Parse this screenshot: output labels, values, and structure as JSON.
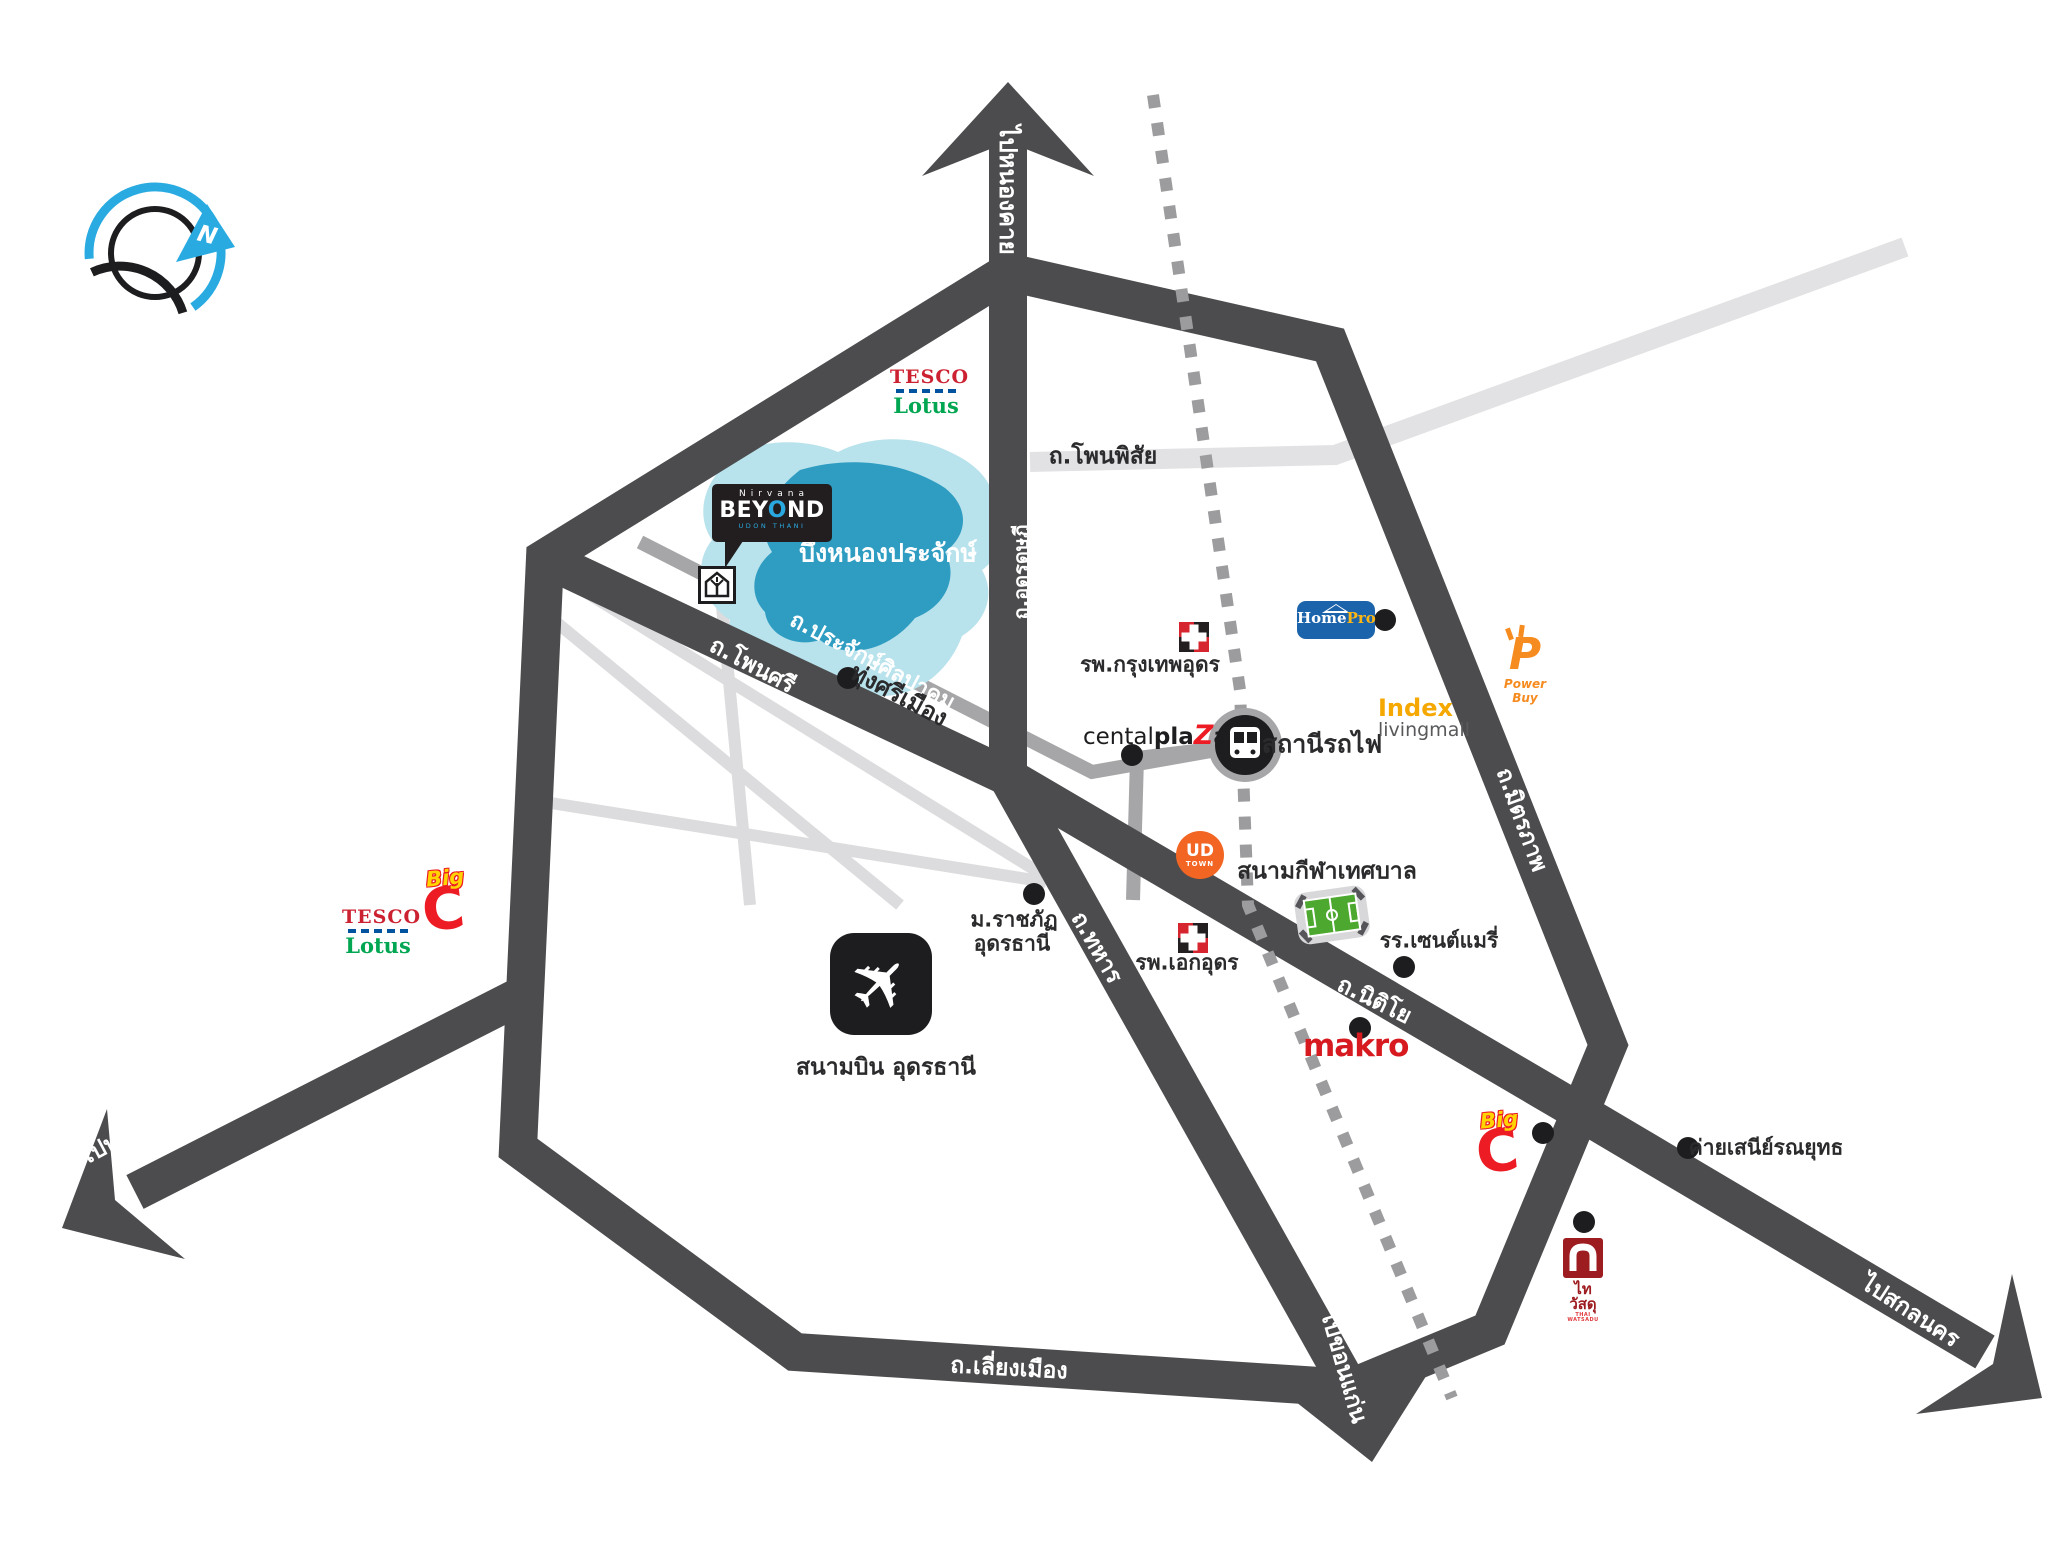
{
  "title": "Nirvana Beyond Udon Thani location map",
  "compass": {
    "north": "N"
  },
  "icons": {
    "airplane": "✈"
  },
  "arrows": {
    "nong_khai": "ไปหนองคาย",
    "nong_bua_lamphu": "ไปหนองบัวลำภู",
    "khon_kaen": "ไปขอนแก่น",
    "sakon_nakhon": "ไปสกลนคร"
  },
  "roads": {
    "phon_phisai": "ถ.โพนพิสัย",
    "udon_dutsadi": "ถ.อุดรดุษฎี",
    "prachak_sinlapakhom": "ถ.ประจักษ์ศิลปาคม",
    "phon_si": "ถ.โพนศรี",
    "thahan": "ถ.ทหาร",
    "mittraphap": "ถ.มิตรภาพ",
    "nittayo": "ถ.นิติโย",
    "liang_mueang": "ถ.เลี่ยงเมือง"
  },
  "places": {
    "lake": "บึงหนองประจักษ์",
    "thung_si_mueang": "ทุ่งศรีเมือง",
    "bangkok_hospital_udon": "รพ.กรุงเทพอุดร",
    "aek_udon_hospital": "รพ.เอกอุดร",
    "train_station": "สถานีรถไฟ",
    "municipal_stadium": "สนามกีฬาเทศบาล",
    "rajabhat_university_line1": "ม.ราชภัฏ",
    "rajabhat_university_line2": "อุดรธานี",
    "airport": "สนามบิน อุดรธานี",
    "st_mary_school": "รร.เซนต์แมรี่",
    "seni_ronnayut_camp": "ค่ายเสนีย์รณยุทธ"
  },
  "brands": {
    "tesco": "TESCO",
    "lotus": "Lotus",
    "big": "Big",
    "big_c": "C",
    "homepro_home": "Home",
    "homepro_pro": "Pro",
    "powerbuy_p": "P",
    "powerbuy": "Power Buy",
    "index": "Index",
    "livingmall": "livingmall",
    "central_pre": "cental",
    "central_pla": "pla",
    "central_z": "Z",
    "central_a": "a",
    "ud": "UD",
    "town": "TOWN",
    "makro": "makro",
    "thai_watsadu": "ไทวัสดุ",
    "thai_watsadu_sub": "THAI WATSADU"
  },
  "project": {
    "nirvana": "Nirvana",
    "beyond_b": "BEY",
    "beyond_o": "O",
    "beyond_nd": "ND",
    "udon_thani": "UDON THANI"
  },
  "colors": {
    "road_dark": "#4c4c4e",
    "road_gray": "#a6a6a8",
    "road_light": "#dcdcde",
    "railway": "#9c9c9e",
    "lake_light": "#b8e2ec",
    "lake_dark": "#2f9dc2",
    "compass_blue": "#29abe2",
    "tesco_red": "#cc2131",
    "tesco_blue": "#00539f",
    "lotus_green": "#00a651",
    "bigc_red": "#ed1c24",
    "bigc_yellow": "#ffd400",
    "homepro_blue": "#1b64ac",
    "powerbuy_orange": "#f68b1f",
    "index_yellow": "#f5a800",
    "udtown_orange": "#f26522",
    "makro_red": "#d71920",
    "thai_watsadu_red": "#9d1c20",
    "nirvana_blue": "#2aa9e0"
  }
}
